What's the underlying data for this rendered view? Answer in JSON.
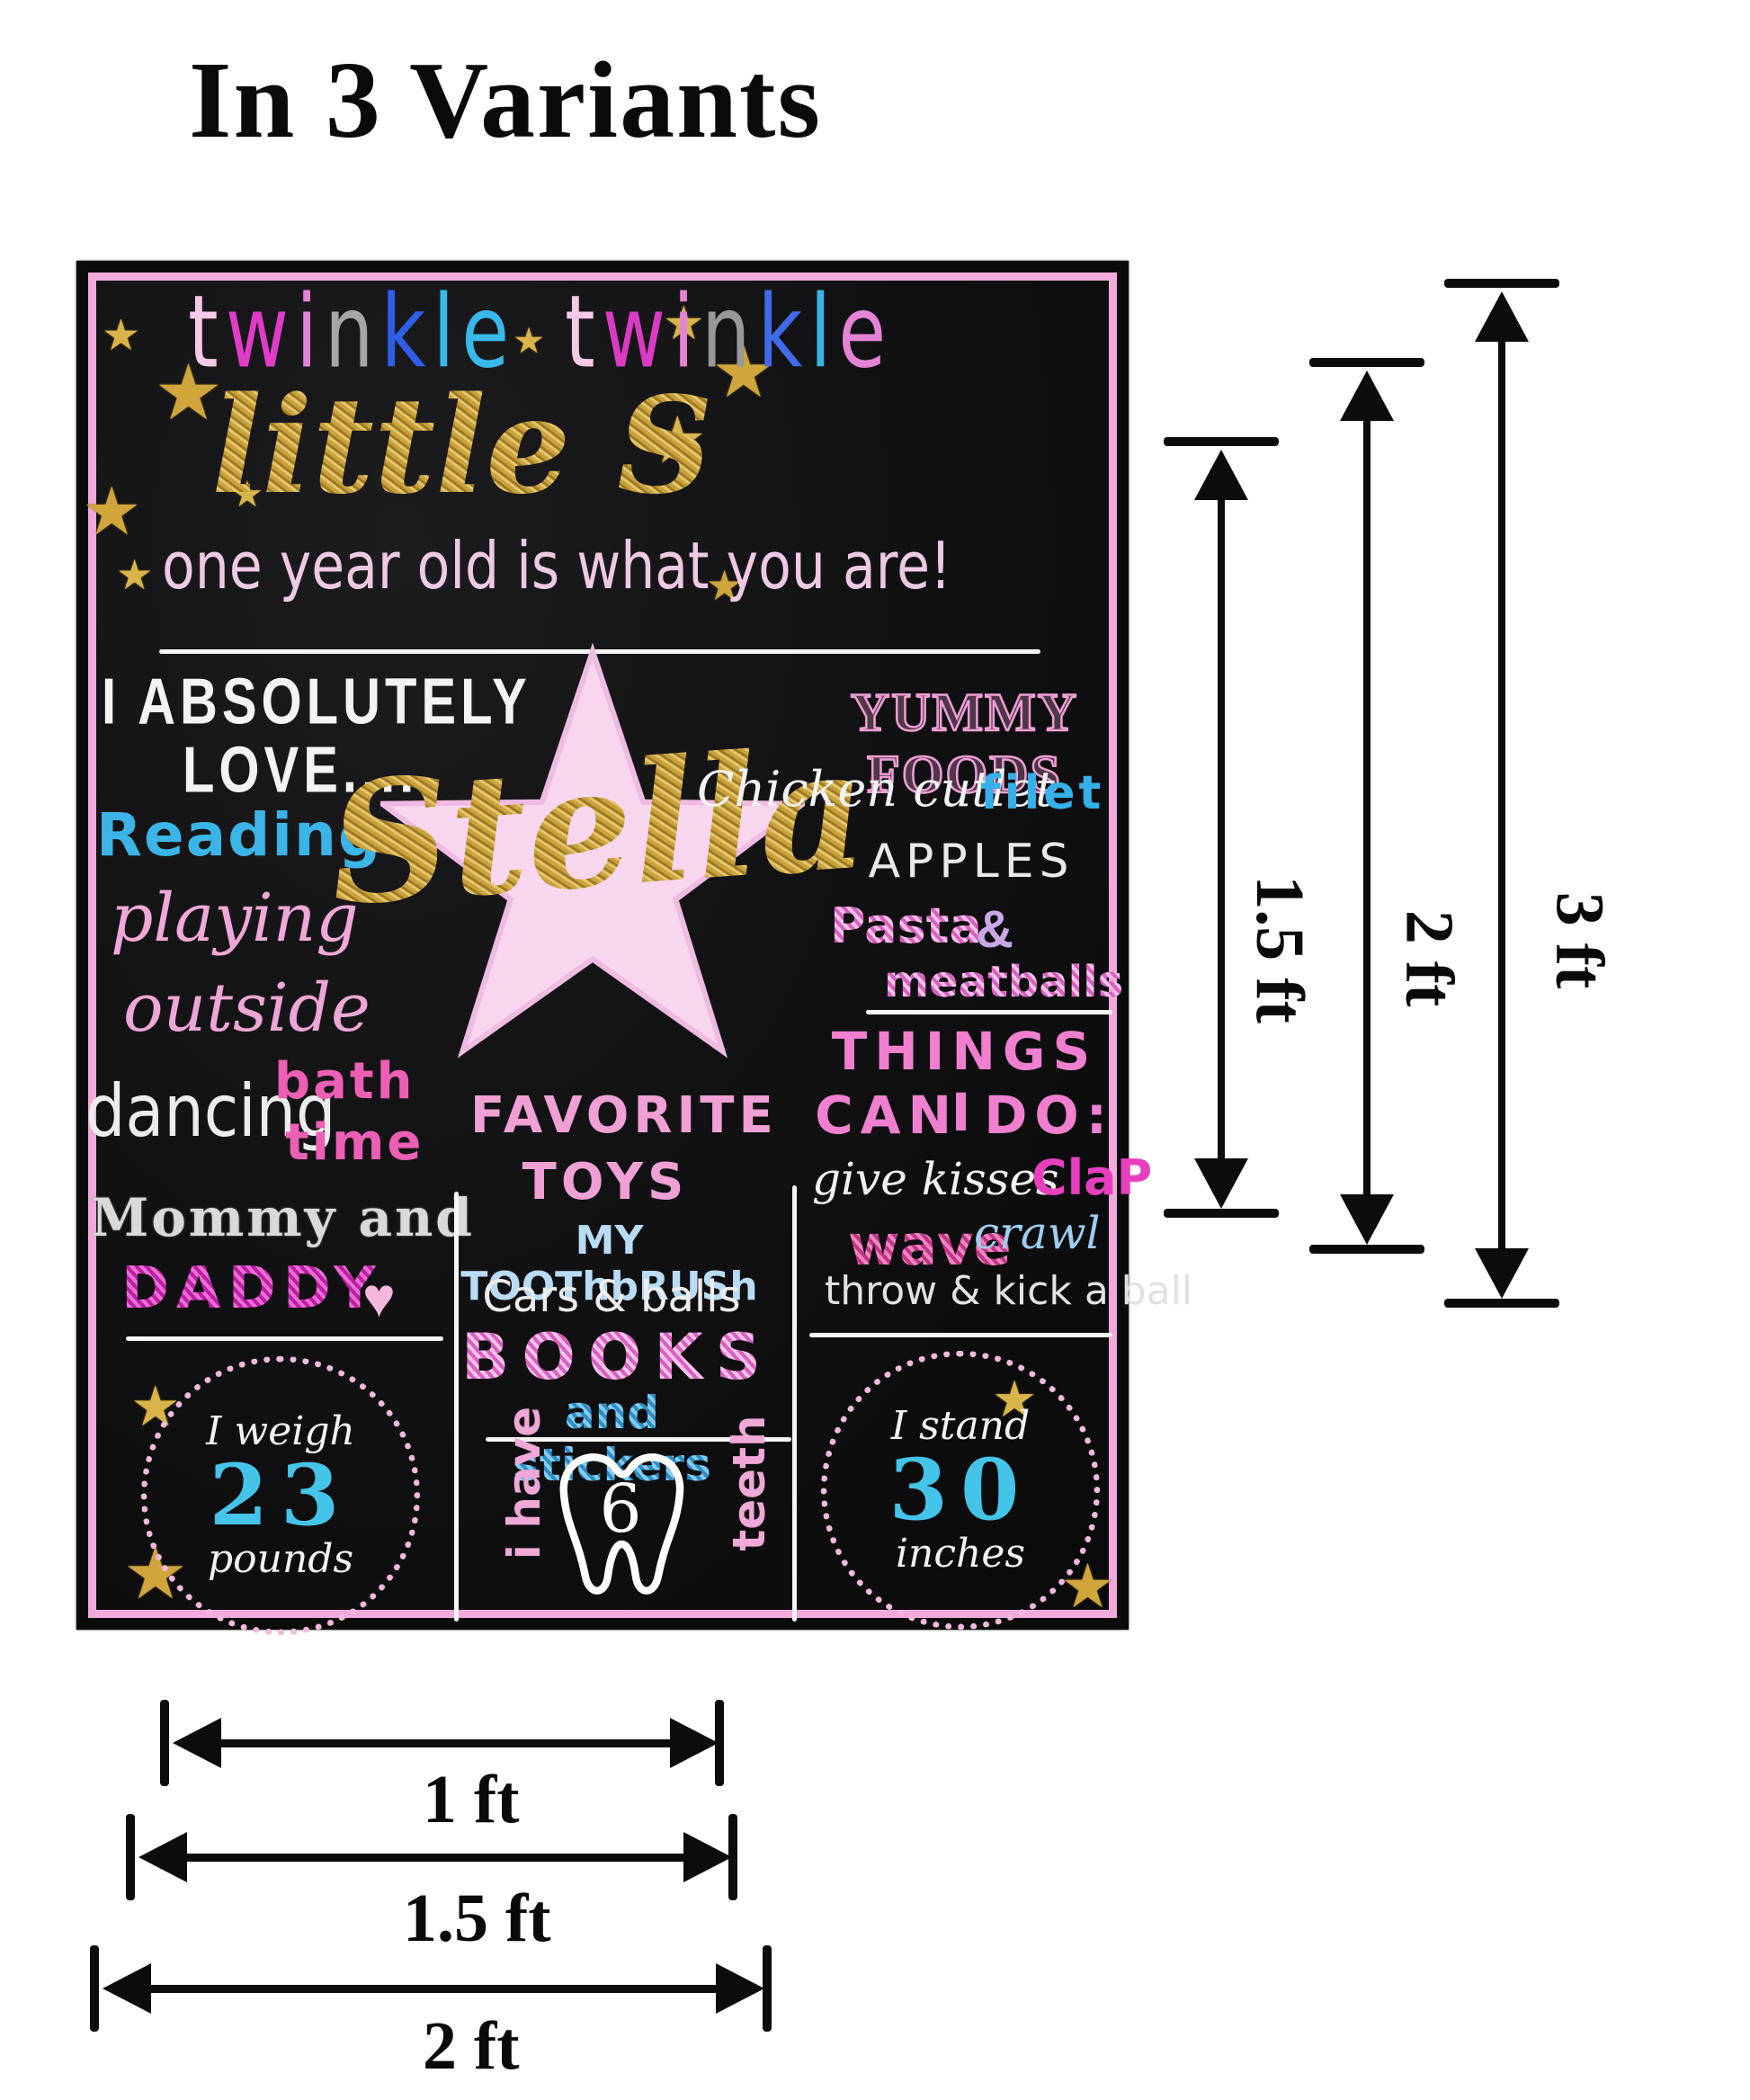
{
  "title": "In 3 Variants",
  "decor": {
    "star_glyph": "★",
    "sparkle_glyph": "★",
    "heart_glyph": "♥"
  },
  "poster": {
    "header": {
      "twinkle1": {
        "text": "twinkle",
        "colors": [
          "#f6c9e6",
          "#e03cc8",
          "#e583d6",
          "#a6a6a6",
          "#2f5fe8",
          "#38b9ea",
          "#38b9ea"
        ]
      },
      "twinkle2": {
        "text": "twinkle",
        "colors": [
          "#f6c9e6",
          "#d93cc2",
          "#e583d6",
          "#989898",
          "#3f6ae8",
          "#3ab4e6",
          "#e583d6"
        ]
      },
      "line2": "little Star",
      "line3": "one year old is what you are!"
    },
    "left": {
      "love1": "I ABSOLUTELY",
      "love2": "LOVE....",
      "reading": "Reading",
      "playing": "playing",
      "outside": "outside",
      "dancing": "dancing",
      "bath": "bath",
      "time": "time",
      "mommy": "Mommy and",
      "daddy": "DADDY",
      "weigh_line1": "I weigh",
      "weigh_value": "23",
      "weigh_line2": "pounds"
    },
    "center": {
      "name": "Stella",
      "fav1": "FAVORITE",
      "fav2": "TOYS",
      "toothbrush": "MY TOOThbRUSh",
      "cars": "Cars & balls",
      "books": "BOOKS",
      "stickers": "and stickers",
      "tooth_left": "i have",
      "tooth_count": "6",
      "tooth_right": "teeth"
    },
    "right": {
      "yummy": "YUMMY FOODS",
      "chicken": "Chicken cutlet",
      "filet": "filet",
      "apples": "APPLES",
      "pasta": "Pasta",
      "amp": "&",
      "meatballs": "meatballs",
      "things1": "THINGS I",
      "things2": "CAN DO:",
      "kisses": "give kisses",
      "clap": "ClaP",
      "wave": "wave",
      "crawl": "crawl",
      "throw": "throw & kick a ball",
      "stand_line1": "I stand",
      "stand_value": "30",
      "stand_line2": "inches"
    }
  },
  "measurements": {
    "vertical": [
      {
        "label": "1.5 ft"
      },
      {
        "label": "2 ft"
      },
      {
        "label": "3 ft"
      }
    ],
    "horizontal": [
      {
        "label": "1 ft"
      },
      {
        "label": "1.5 ft"
      },
      {
        "label": "2 ft"
      }
    ]
  }
}
